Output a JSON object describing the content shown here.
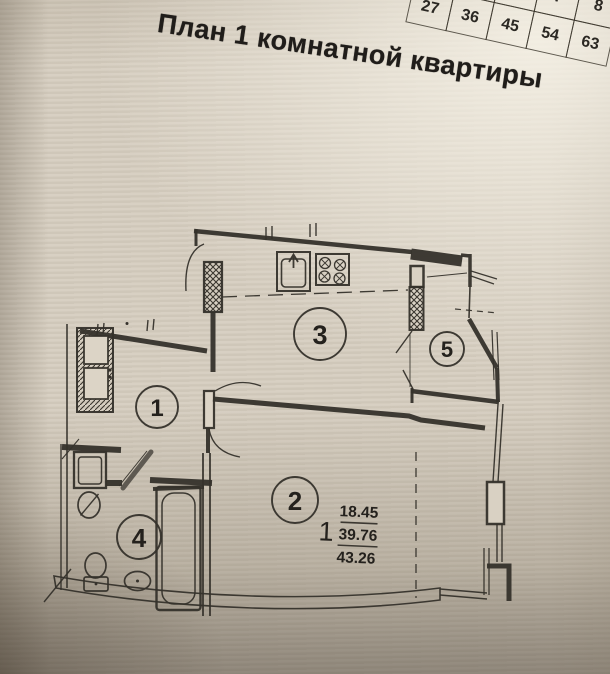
{
  "page": {
    "title": "План 1 комнатной квартиры"
  },
  "table": {
    "rows": [
      [
        "",
        "",
        "",
        "7",
        "8"
      ],
      [
        "27",
        "36",
        "45",
        "54",
        "63"
      ]
    ]
  },
  "plan": {
    "rooms": [
      {
        "number": "1"
      },
      {
        "number": "2"
      },
      {
        "number": "3"
      },
      {
        "number": "4"
      },
      {
        "number": "5"
      }
    ],
    "area_block": {
      "rooms_count": "1",
      "living_area": "18.45",
      "total_area": "39.76",
      "overall_area": "43.26"
    },
    "colors": {
      "paper": "#d6cec0",
      "line": "#35312b",
      "shadow": "#8d8272"
    }
  }
}
